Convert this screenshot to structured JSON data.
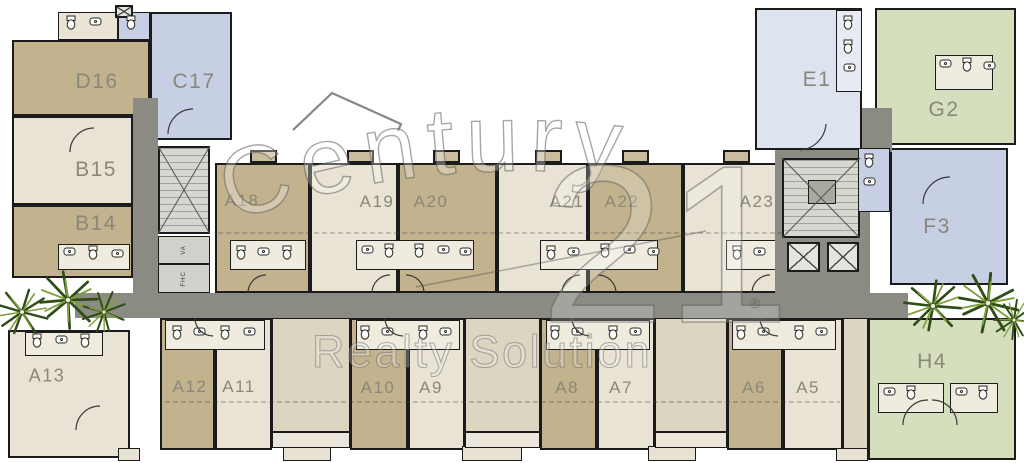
{
  "plan": {
    "watermark": {
      "line1": "Century",
      "number": "21",
      "line2": "Realty Solution",
      "registered": "®"
    },
    "palette": {
      "tan": "#c2b28e",
      "cream": "#e8e3d4",
      "cream2": "#dcd5c2",
      "blue": "#c6cfe3",
      "lavender": "#dee3f0",
      "lavbath": "#e8ebf4",
      "green": "#d5dfbe",
      "bath": "#efebdf",
      "bathTop": "#e9e4d6",
      "stairdark": "#a9a9a0",
      "corridor": "#8b8b83",
      "wall": "#1b1b1b",
      "label": "#8a8878"
    },
    "units": [
      {
        "label": "D16",
        "color": "tan",
        "x": 12,
        "y": 40,
        "w": 138,
        "h": 76,
        "lx": 97,
        "ly": 82,
        "fs": 21
      },
      {
        "label": "C17",
        "color": "blue",
        "x": 150,
        "y": 12,
        "w": 82,
        "h": 128,
        "lx": 194,
        "ly": 82,
        "fs": 21
      },
      {
        "label": "B15",
        "color": "cream",
        "x": 12,
        "y": 116,
        "w": 121,
        "h": 89,
        "lx": 96,
        "ly": 170,
        "fs": 21
      },
      {
        "label": "B14",
        "color": "tan",
        "x": 12,
        "y": 205,
        "w": 121,
        "h": 73,
        "lx": 96,
        "ly": 224,
        "fs": 21
      },
      {
        "label": "A13",
        "color": "cream",
        "x": 8,
        "y": 330,
        "w": 122,
        "h": 128,
        "lx": 47,
        "ly": 376,
        "fs": 18
      },
      {
        "label": "A18",
        "color": "tan",
        "x": 215,
        "y": 163,
        "w": 95,
        "h": 130,
        "lx": 242,
        "ly": 201,
        "fs": 17
      },
      {
        "label": "A19",
        "color": "cream",
        "x": 310,
        "y": 163,
        "w": 88,
        "h": 130,
        "lx": 377,
        "ly": 202,
        "fs": 17
      },
      {
        "label": "A20",
        "color": "tan",
        "x": 398,
        "y": 163,
        "w": 99,
        "h": 130,
        "lx": 431,
        "ly": 202,
        "fs": 17
      },
      {
        "label": "A21",
        "color": "cream",
        "x": 497,
        "y": 163,
        "w": 91,
        "h": 130,
        "lx": 567,
        "ly": 202,
        "fs": 17
      },
      {
        "label": "A22",
        "color": "tan",
        "x": 588,
        "y": 163,
        "w": 95,
        "h": 130,
        "lx": 622,
        "ly": 202,
        "fs": 17
      },
      {
        "label": "A23",
        "color": "cream",
        "x": 683,
        "y": 163,
        "w": 97,
        "h": 130,
        "lx": 757,
        "ly": 202,
        "fs": 17
      },
      {
        "label": "A12",
        "color": "tan",
        "x": 160,
        "y": 318,
        "w": 55,
        "h": 132,
        "lx": 190,
        "ly": 387,
        "fs": 17
      },
      {
        "label": "A11",
        "color": "cream",
        "x": 215,
        "y": 318,
        "w": 57,
        "h": 132,
        "lx": 239,
        "ly": 387,
        "fs": 17
      },
      {
        "label": "A10",
        "color": "tan",
        "x": 350,
        "y": 318,
        "w": 58,
        "h": 132,
        "lx": 378,
        "ly": 388,
        "fs": 17
      },
      {
        "label": "A9",
        "color": "cream",
        "x": 408,
        "y": 318,
        "w": 57,
        "h": 132,
        "lx": 431,
        "ly": 388,
        "fs": 17
      },
      {
        "label": "A8",
        "color": "tan",
        "x": 540,
        "y": 318,
        "w": 57,
        "h": 132,
        "lx": 567,
        "ly": 388,
        "fs": 17
      },
      {
        "label": "A7",
        "color": "cream",
        "x": 597,
        "y": 318,
        "w": 58,
        "h": 132,
        "lx": 621,
        "ly": 388,
        "fs": 17
      },
      {
        "label": "A6",
        "color": "tan",
        "x": 727,
        "y": 318,
        "w": 56,
        "h": 132,
        "lx": 754,
        "ly": 388,
        "fs": 17
      },
      {
        "label": "A5",
        "color": "cream",
        "x": 783,
        "y": 318,
        "w": 60,
        "h": 132,
        "lx": 808,
        "ly": 388,
        "fs": 17
      },
      {
        "label": "E1",
        "color": "lavender",
        "x": 755,
        "y": 8,
        "w": 107,
        "h": 142,
        "lx": 817,
        "ly": 80,
        "fs": 21
      },
      {
        "label": "G2",
        "color": "green",
        "x": 875,
        "y": 8,
        "w": 141,
        "h": 137,
        "lx": 944,
        "ly": 110,
        "fs": 21
      },
      {
        "label": "F3",
        "color": "blue",
        "x": 890,
        "y": 148,
        "w": 118,
        "h": 137,
        "lx": 937,
        "ly": 227,
        "fs": 21
      },
      {
        "label": "H4",
        "color": "green",
        "x": 868,
        "y": 318,
        "w": 148,
        "h": 142,
        "lx": 932,
        "ly": 362,
        "fs": 21
      }
    ],
    "rooms": [
      {
        "color": "bathTop",
        "x": 58,
        "y": 12,
        "w": 60,
        "h": 28
      },
      {
        "color": "blue",
        "x": 118,
        "y": 12,
        "w": 32,
        "h": 28
      },
      {
        "color": "bath",
        "x": 58,
        "y": 244,
        "w": 72,
        "h": 26
      },
      {
        "color": "cream2",
        "x": 272,
        "y": 318,
        "w": 78,
        "h": 114
      },
      {
        "color": "cream2",
        "x": 465,
        "y": 318,
        "w": 75,
        "h": 114
      },
      {
        "color": "cream2",
        "x": 655,
        "y": 318,
        "w": 72,
        "h": 114
      },
      {
        "color": "cream2",
        "x": 843,
        "y": 318,
        "w": 25,
        "h": 132
      },
      {
        "color": "bath",
        "x": 230,
        "y": 240,
        "w": 76,
        "h": 30
      },
      {
        "color": "bath",
        "x": 356,
        "y": 240,
        "w": 118,
        "h": 30
      },
      {
        "color": "bath",
        "x": 540,
        "y": 240,
        "w": 118,
        "h": 30
      },
      {
        "color": "bath",
        "x": 726,
        "y": 240,
        "w": 62,
        "h": 30
      },
      {
        "color": "bath",
        "x": 165,
        "y": 320,
        "w": 100,
        "h": 30
      },
      {
        "color": "bath",
        "x": 356,
        "y": 320,
        "w": 104,
        "h": 30
      },
      {
        "color": "bath",
        "x": 546,
        "y": 320,
        "w": 104,
        "h": 30
      },
      {
        "color": "bath",
        "x": 732,
        "y": 320,
        "w": 104,
        "h": 30
      },
      {
        "color": "bath",
        "x": 25,
        "y": 332,
        "w": 78,
        "h": 24
      },
      {
        "color": "lavbath",
        "x": 836,
        "y": 10,
        "w": 26,
        "h": 82
      },
      {
        "color": "bath",
        "x": 935,
        "y": 55,
        "w": 58,
        "h": 35
      },
      {
        "color": "bath",
        "x": 878,
        "y": 383,
        "w": 66,
        "h": 30
      },
      {
        "color": "bath",
        "x": 950,
        "y": 383,
        "w": 48,
        "h": 30
      }
    ],
    "rooms2": [
      {
        "color": "blue",
        "x": 858,
        "y": 148,
        "w": 32,
        "h": 64
      },
      {
        "color": "stairdark",
        "x": 808,
        "y": 180,
        "w": 28,
        "h": 24
      }
    ],
    "circulation": {
      "corridors": [
        {
          "x": 75,
          "y": 293,
          "w": 833,
          "h": 25
        },
        {
          "x": 133,
          "y": 98,
          "w": 25,
          "h": 197
        },
        {
          "x": 862,
          "y": 108,
          "w": 30,
          "h": 44
        },
        {
          "x": 775,
          "y": 150,
          "w": 95,
          "h": 145
        }
      ],
      "stairs": [
        {
          "x": 158,
          "y": 146,
          "w": 52,
          "h": 88
        },
        {
          "x": 782,
          "y": 158,
          "w": 78,
          "h": 80
        }
      ],
      "elevators": [
        {
          "x": 787,
          "y": 242,
          "w": 33,
          "h": 30
        },
        {
          "x": 827,
          "y": 242,
          "w": 32,
          "h": 30
        },
        {
          "x": 115,
          "y": 5,
          "w": 18,
          "h": 13
        }
      ],
      "service_rooms": [
        {
          "x": 158,
          "y": 236,
          "w": 52,
          "h": 28,
          "t": "VA"
        },
        {
          "x": 158,
          "y": 264,
          "w": 52,
          "h": 29,
          "t": "FHC"
        }
      ]
    },
    "balconies": {
      "top": [
        {
          "x": 250,
          "y": 150,
          "w": 27,
          "h": 13
        },
        {
          "x": 347,
          "y": 150,
          "w": 27,
          "h": 13
        },
        {
          "x": 433,
          "y": 150,
          "w": 27,
          "h": 13
        },
        {
          "x": 535,
          "y": 150,
          "w": 27,
          "h": 13
        },
        {
          "x": 622,
          "y": 150,
          "w": 27,
          "h": 13
        },
        {
          "x": 723,
          "y": 150,
          "w": 27,
          "h": 13
        }
      ],
      "bottom": [
        {
          "x": 118,
          "y": 448,
          "w": 22,
          "h": 13
        },
        {
          "x": 283,
          "y": 446,
          "w": 48,
          "h": 15
        },
        {
          "x": 462,
          "y": 446,
          "w": 60,
          "h": 15
        },
        {
          "x": 648,
          "y": 446,
          "w": 48,
          "h": 15
        },
        {
          "x": 836,
          "y": 448,
          "w": 32,
          "h": 13
        }
      ],
      "strips": [
        {
          "x": 272,
          "y": 432,
          "w": 78,
          "h": 16
        },
        {
          "x": 465,
          "y": 432,
          "w": 75,
          "h": 16
        },
        {
          "x": 655,
          "y": 432,
          "w": 72,
          "h": 16
        }
      ]
    },
    "vegetation": {
      "palms": [
        {
          "x": 22,
          "y": 312,
          "s": 1.0,
          "r": 10
        },
        {
          "x": 68,
          "y": 300,
          "s": 1.15,
          "r": 40
        },
        {
          "x": 104,
          "y": 312,
          "s": 0.85,
          "r": -25
        },
        {
          "x": 933,
          "y": 306,
          "s": 1.1,
          "r": 0
        },
        {
          "x": 988,
          "y": 303,
          "s": 1.2,
          "r": 55
        },
        {
          "x": 1014,
          "y": 320,
          "s": 0.8,
          "r": -40
        }
      ]
    }
  }
}
